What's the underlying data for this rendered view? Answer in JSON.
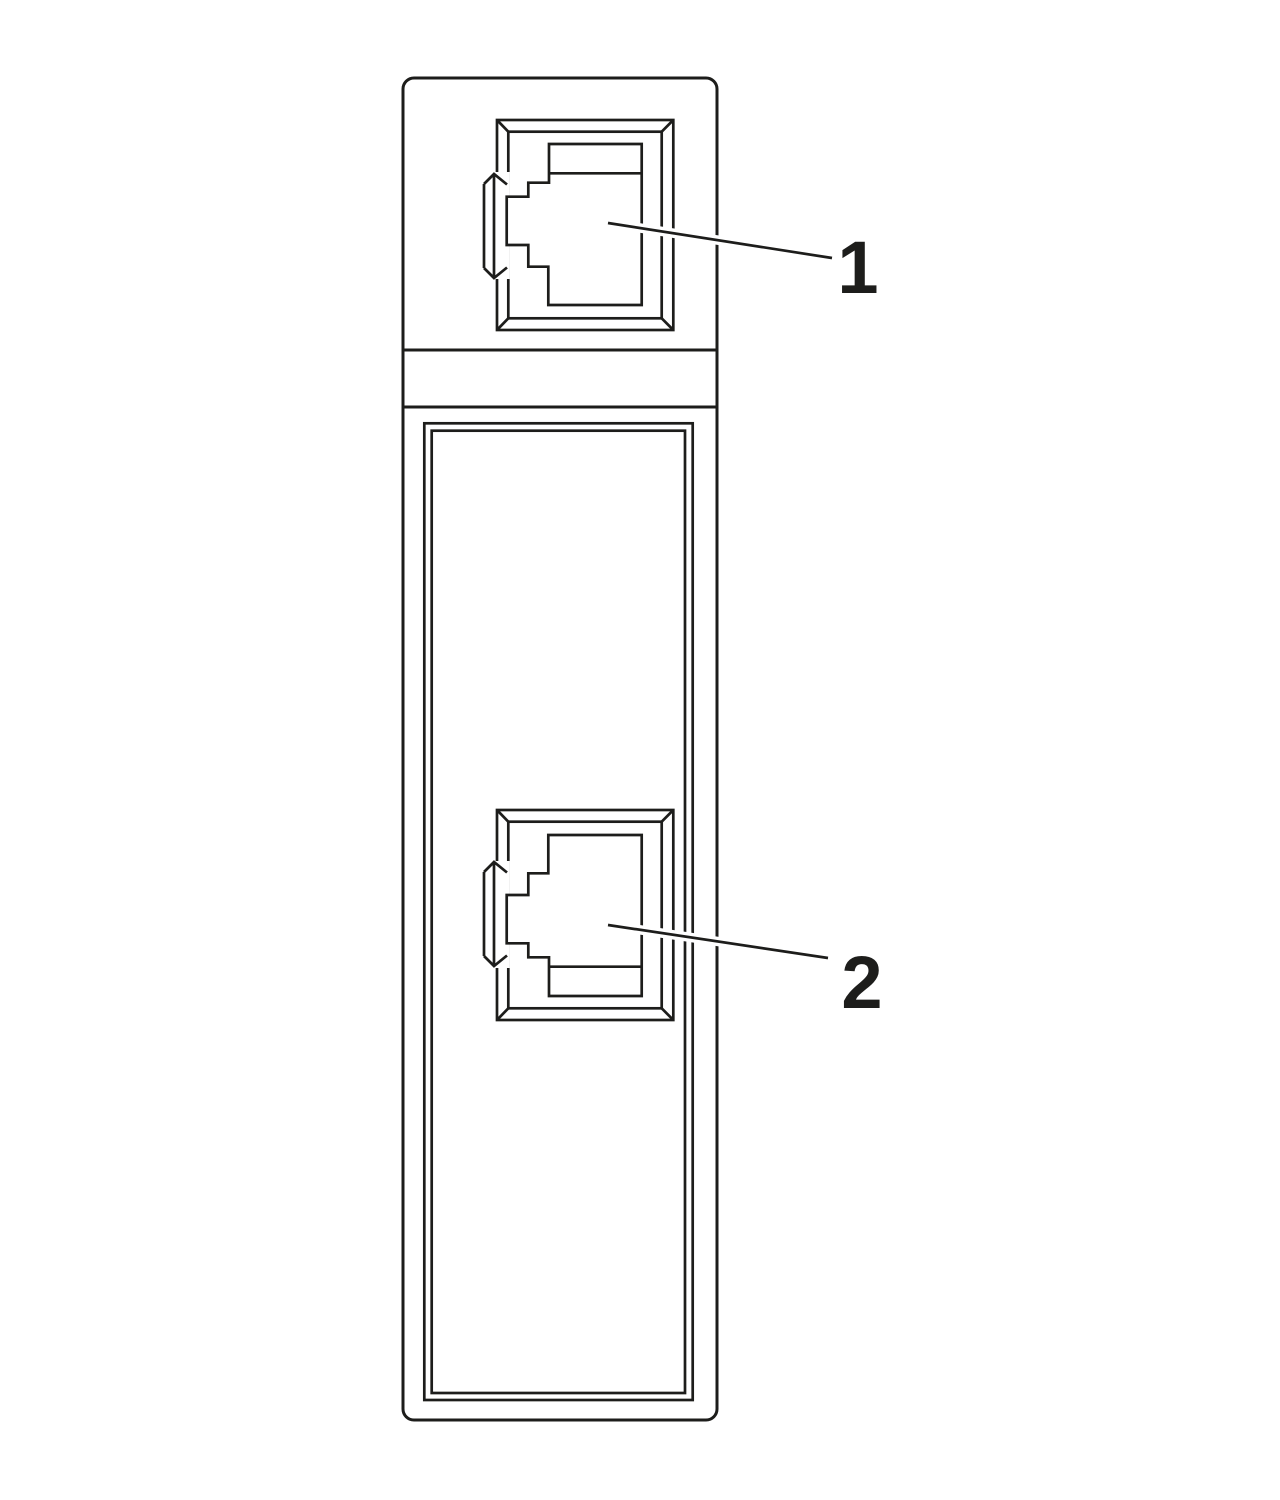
{
  "diagram": {
    "background_color": "#ffffff",
    "line_color": "#1d1d1b",
    "device": {
      "name": "din-rail-module-side-panel",
      "ports": [
        {
          "name": "upper-rj45-port",
          "callout": "1"
        },
        {
          "name": "lower-rj45-port",
          "callout": "2"
        }
      ]
    },
    "callouts": [
      {
        "label": "1",
        "target": "upper-rj45-port"
      },
      {
        "label": "2",
        "target": "lower-rj45-port"
      }
    ]
  }
}
